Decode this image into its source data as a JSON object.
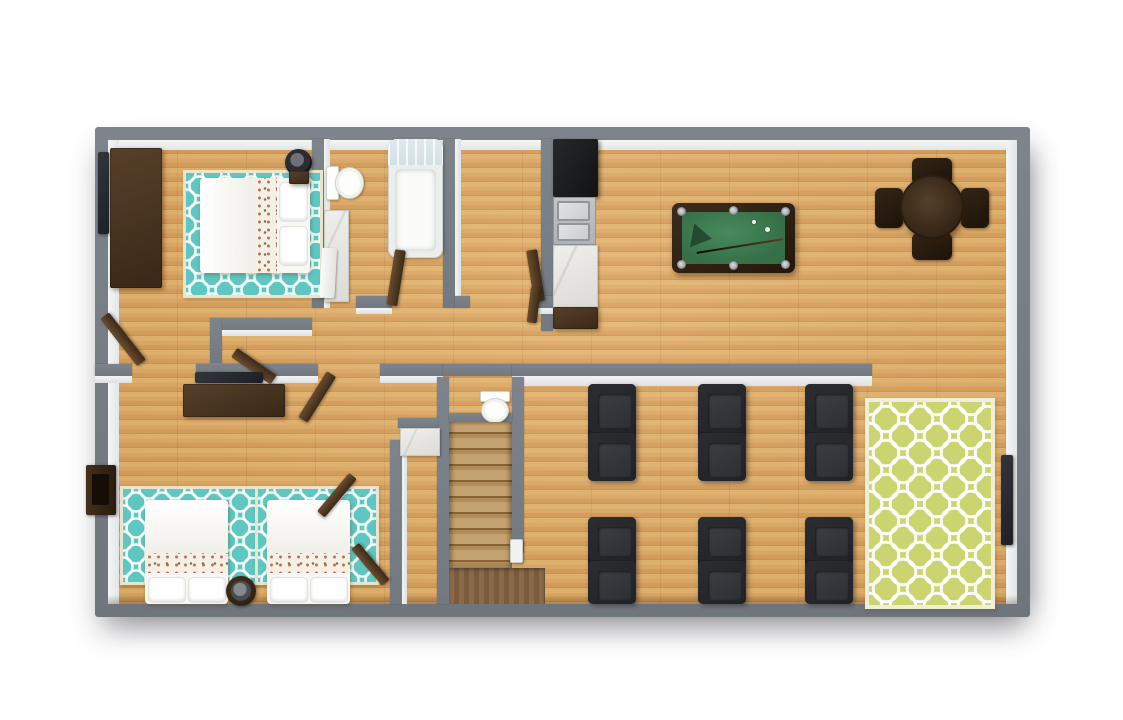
{
  "scene": {
    "kind": "3d-floorplan-top-down-render",
    "floors": 1,
    "background": "#ffffff",
    "no_visible_text": true
  },
  "colors": {
    "wall": "#7e848c",
    "wall-dark": "#6f757d",
    "teal": "#5fc7c1",
    "rug-green": "#cbd46f"
  },
  "rooms": [
    {
      "name": "bedroom-1",
      "position": "top-left",
      "furniture": [
        "dresser",
        "wall-tv",
        "double-bed",
        "teal-trellis-rug",
        "pedestal-fan",
        "open-door"
      ]
    },
    {
      "name": "bathroom-1",
      "position": "top-middle-left",
      "furniture": [
        "toilet",
        "marble-vanity",
        "shower-tub-with-glass",
        "white-door"
      ]
    },
    {
      "name": "closet-room",
      "position": "top-middle",
      "furniture": [
        "open-door"
      ]
    },
    {
      "name": "kitchen-strip",
      "position": "top-middle-right",
      "furniture": [
        "refrigerator",
        "double-basin-sink",
        "marble-counter",
        "base-cabinet"
      ]
    },
    {
      "name": "great-room",
      "position": "right",
      "furniture": [
        "pool-table",
        "round-dining-table",
        "four-dining-chairs",
        "six-theater-seat-pairs",
        "green-trellis-rug",
        "wall-tv"
      ]
    },
    {
      "name": "bedroom-2",
      "position": "bottom-left",
      "furniture": [
        "dresser",
        "wall-tv",
        "twin-bed",
        "twin-bed",
        "two-teal-trellis-rugs",
        "round-fan-table",
        "closet-double-doors",
        "window-box"
      ]
    },
    {
      "name": "powder-room",
      "position": "center",
      "furniture": [
        "toilet",
        "small-marble-sink"
      ]
    },
    {
      "name": "stairwell",
      "position": "center-bottom",
      "furniture": [
        "staircase",
        "wood-landing",
        "white-newel-post"
      ]
    }
  ],
  "pool_table": {
    "felt_color": "#3f7e53",
    "pockets": 6,
    "accessories": [
      "triangle-rack",
      "cue-stick",
      "cue-ball",
      "object-ball"
    ]
  },
  "theater_seating": {
    "rows": 2,
    "columns": 3,
    "chairs_per_unit": 2,
    "color": "#26282b"
  }
}
